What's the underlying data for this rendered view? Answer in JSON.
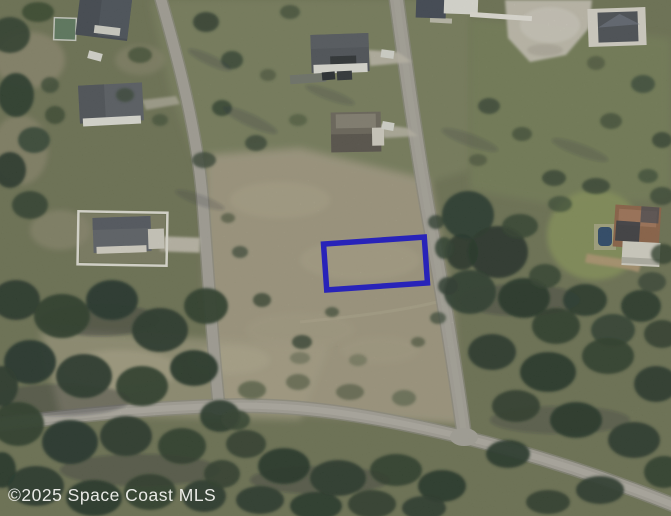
{
  "watermark": {
    "text": "©2025 Space Coast MLS",
    "color": "#f4f4f1"
  },
  "parcel": {
    "outline_color": "#2823b9"
  },
  "palette": {
    "terrain_base": "#6d7354",
    "field_tan": "#a39b83",
    "lawn_green": "#7a815f",
    "east_lawn": "#768059",
    "estate_lawn": "#87945a",
    "road_gray": "#a8a59d",
    "road_edge": "#8f8d85",
    "sand_pad": "#cbc6ba",
    "tree_dark": "#243528",
    "tree_shadow": "#16222c",
    "roof_dark": "#474c55",
    "wall_white": "#e8e7e1",
    "estate_roof": "#8f6246",
    "pool_blue": "#27456b"
  }
}
